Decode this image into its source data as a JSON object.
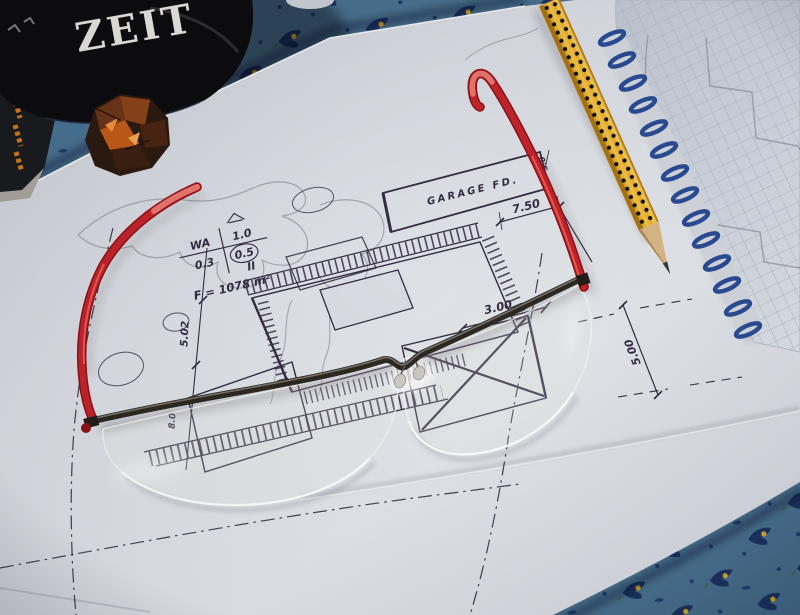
{
  "mug": {
    "text": "ZEIT"
  },
  "site_plan": {
    "garage_label": "GARAGE  FD.",
    "area_label": "F = 1078 m²",
    "zoning": {
      "wa": "WA",
      "grz": "0.3",
      "roof_val": "1.0",
      "gfz": "0.5",
      "floors": "II"
    },
    "dimensions": {
      "d750": "7.50",
      "d300": "3.00",
      "d500": "5.00",
      "d502": "5.02",
      "d80": "8.0",
      "d50": "5.0"
    }
  },
  "colors": {
    "cloth": "#48708f",
    "cloth-motif": "#1b3260",
    "cloth-accent": "#d8a828",
    "paper": "#d8dbe1",
    "ink": "#362c42",
    "pencil-line": "#8a8794",
    "red-frame": "#c1242b",
    "metal": "#2e2822",
    "pencil-yellow": "#e8a820",
    "wood": "#d9b886",
    "spiral": "#2a4c94",
    "note-paper": "#ced3db",
    "grid": "#aeb8c8",
    "mug": "#0c0b0d",
    "mug-text": "#e3e1dd",
    "foil-copper": "#c05a18"
  }
}
